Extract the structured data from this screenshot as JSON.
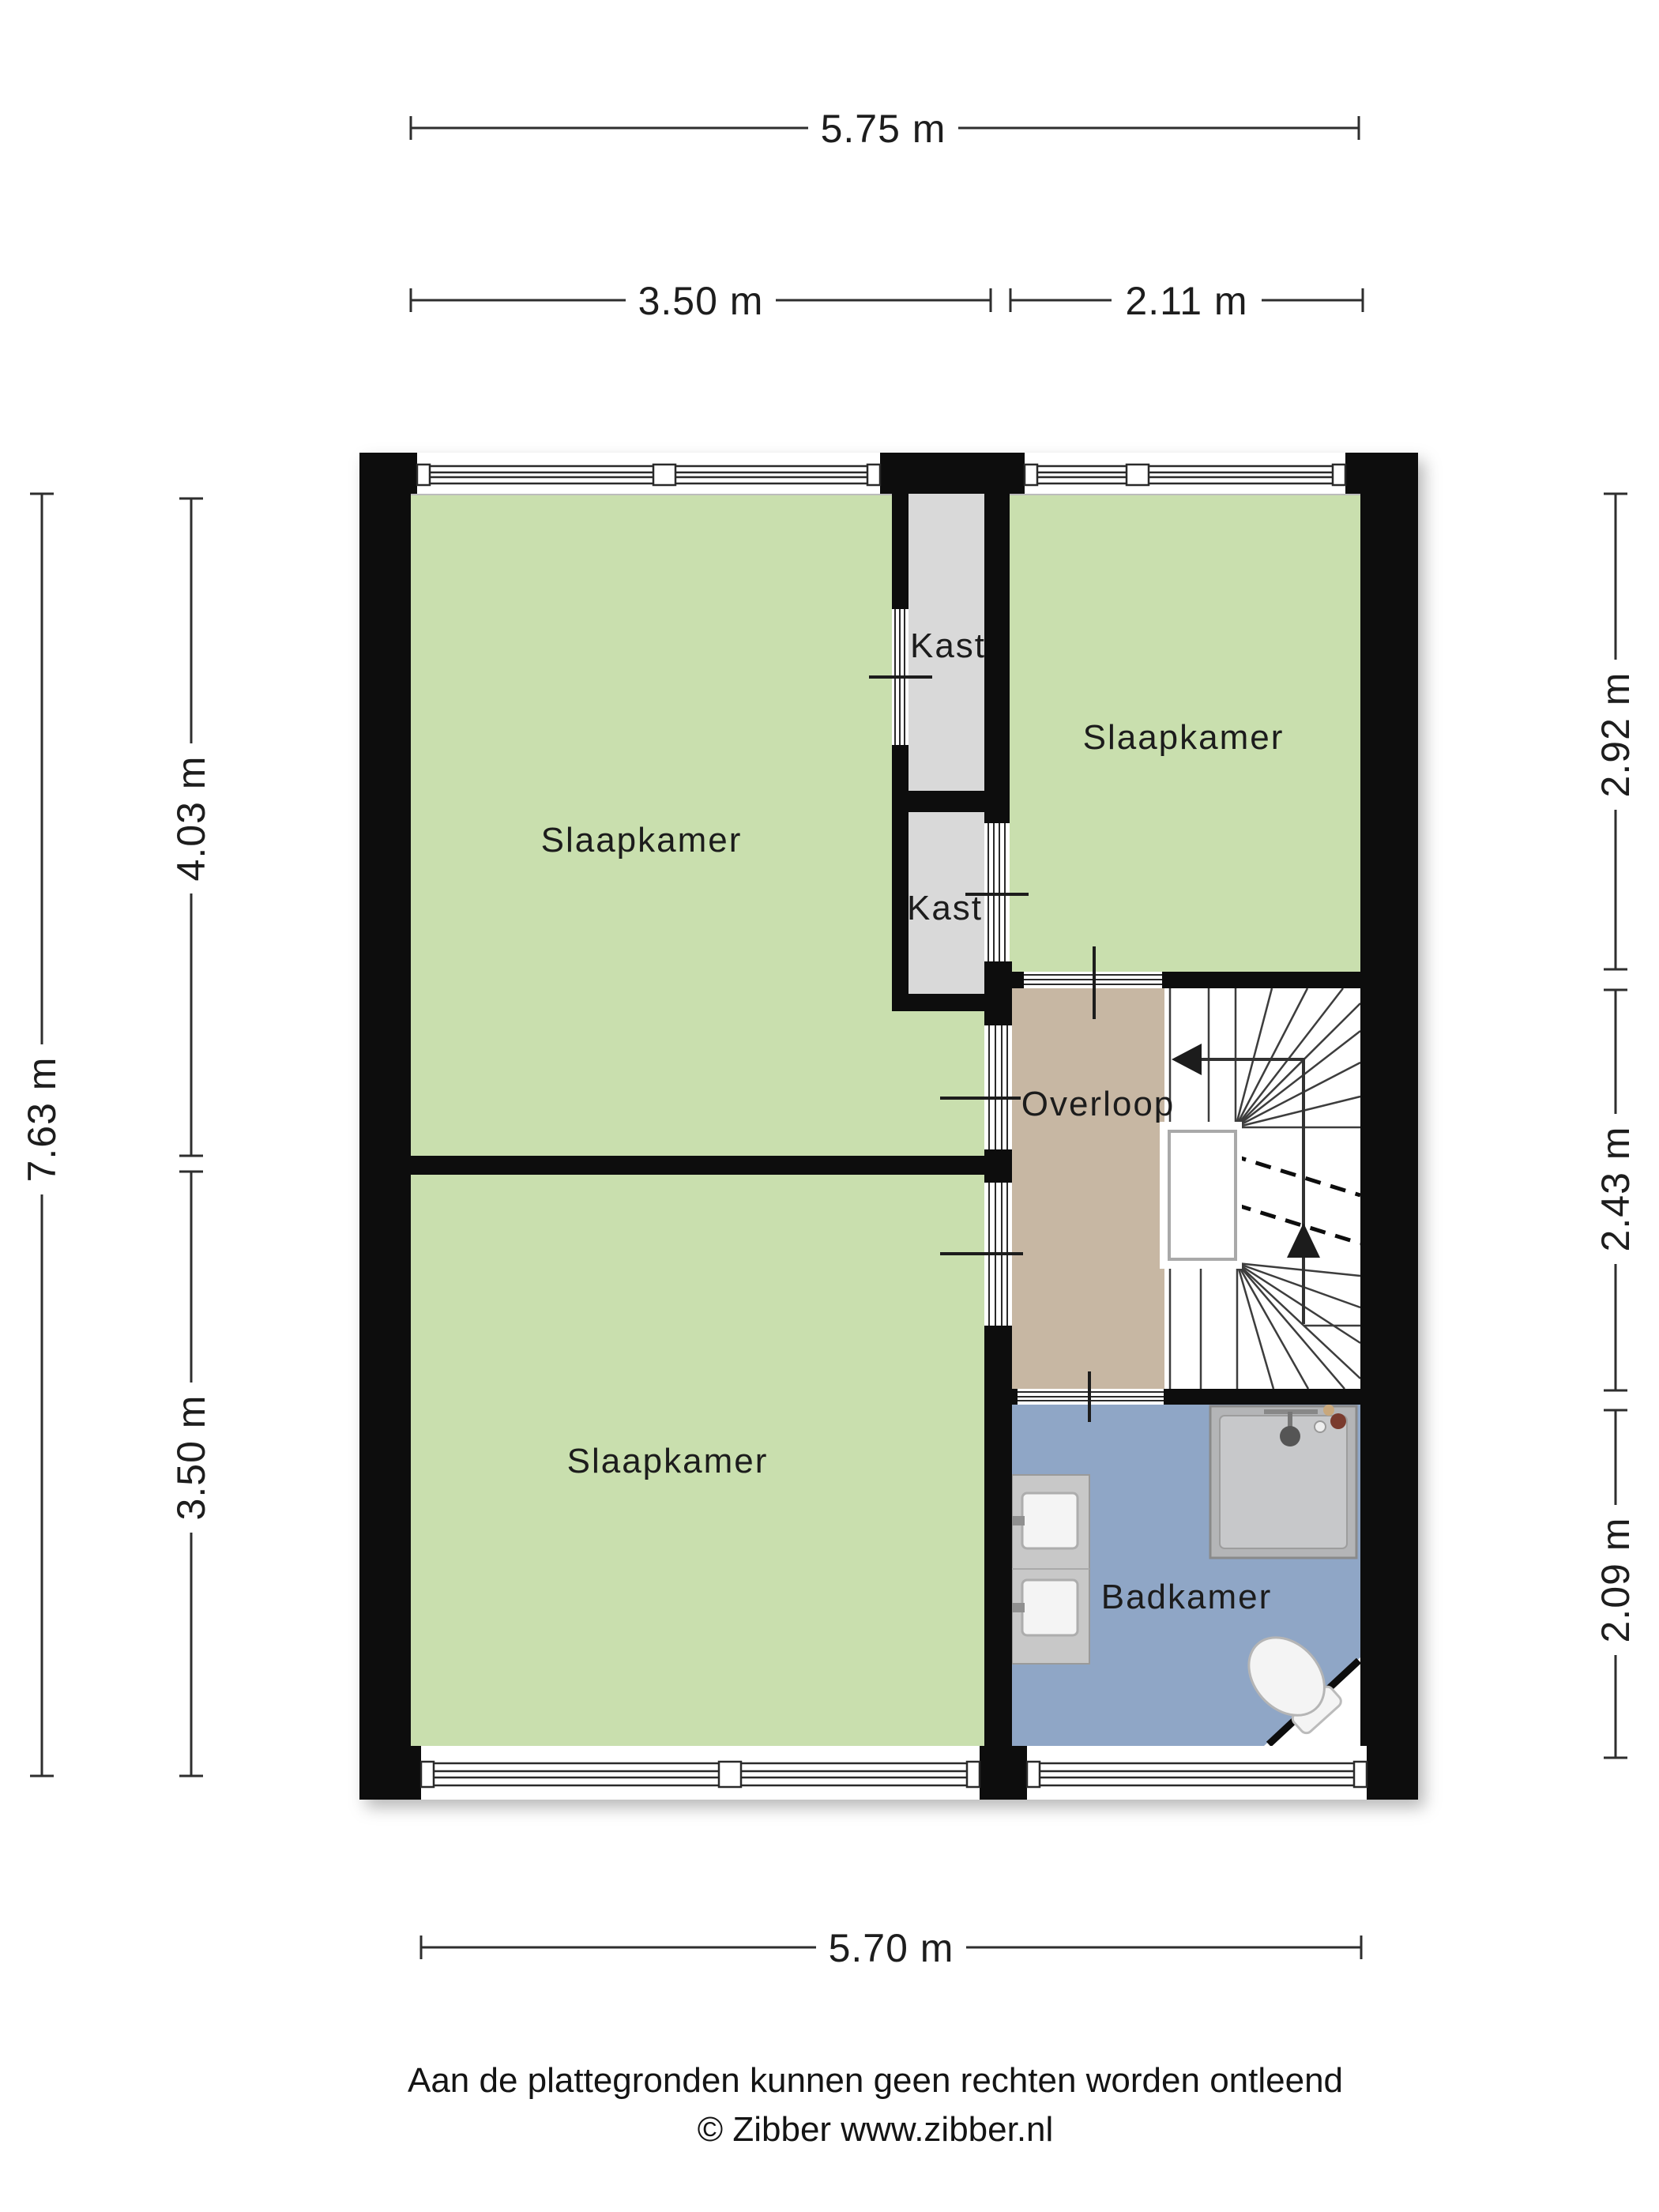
{
  "dimensions": {
    "top_total": "5.75 m",
    "top_left": "3.50 m",
    "top_right": "2.11 m",
    "bottom_total": "5.70 m",
    "left_total": "7.63 m",
    "left_upper": "4.03 m",
    "left_lower": "3.50 m",
    "right_upper": "2.92 m",
    "right_middle": "2.43 m",
    "right_lower": "2.09 m"
  },
  "rooms": {
    "bedroom_top_left": "Slaapkamer",
    "bedroom_top_right": "Slaapkamer",
    "bedroom_bottom": "Slaapkamer",
    "closet_top": "Kast",
    "closet_bottom": "Kast",
    "landing": "Overloop",
    "bathroom": "Badkamer"
  },
  "footer": {
    "line1": "Aan de plattegronden kunnen geen rechten worden ontleend",
    "line2": "© Zibber www.zibber.nl"
  },
  "colors": {
    "wall": "#080808",
    "bedroom": "#c9dfae",
    "closet": "#d9d9d9",
    "landing": "#c7b7a3",
    "bathroom": "#8fa6c6",
    "shower": "#b4b5b7",
    "shower_inner": "#c7c8ca",
    "counter": "#c8c8c8",
    "fixture_white": "#f4f4f4"
  }
}
